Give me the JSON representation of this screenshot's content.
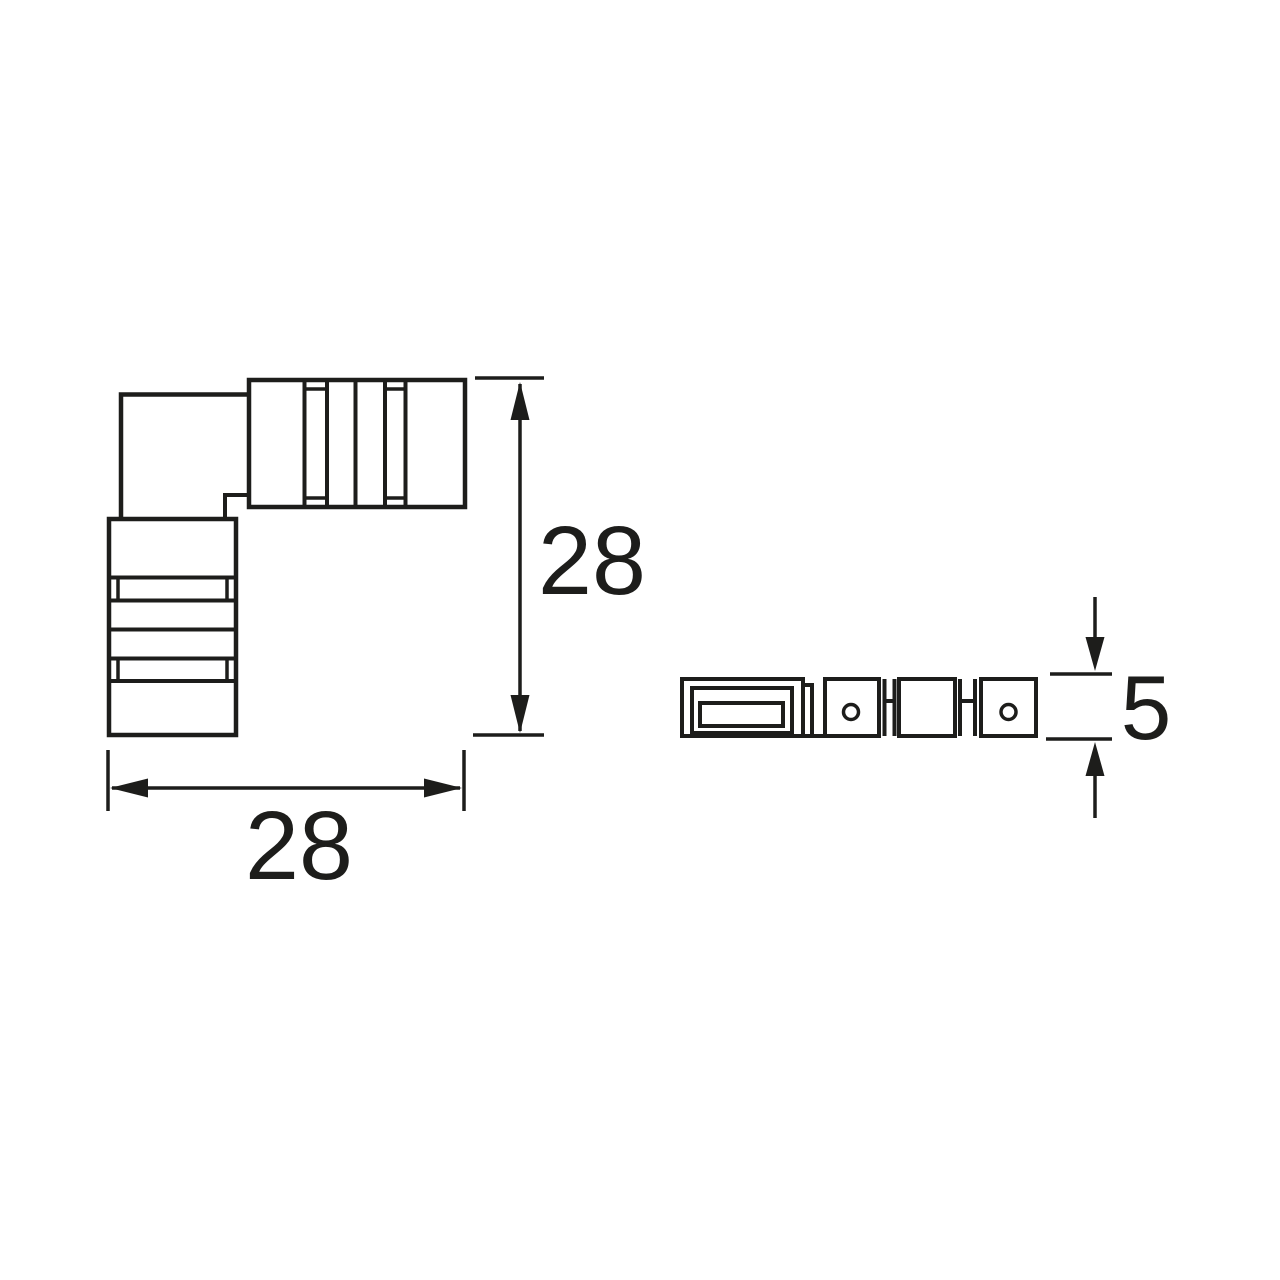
{
  "drawing": {
    "colors": {
      "line": "#1d1d1b",
      "background": "#ffffff"
    },
    "dimensions": {
      "front_height": {
        "label": "28"
      },
      "front_width": {
        "label": "28"
      },
      "side_height": {
        "label": "5"
      }
    }
  }
}
